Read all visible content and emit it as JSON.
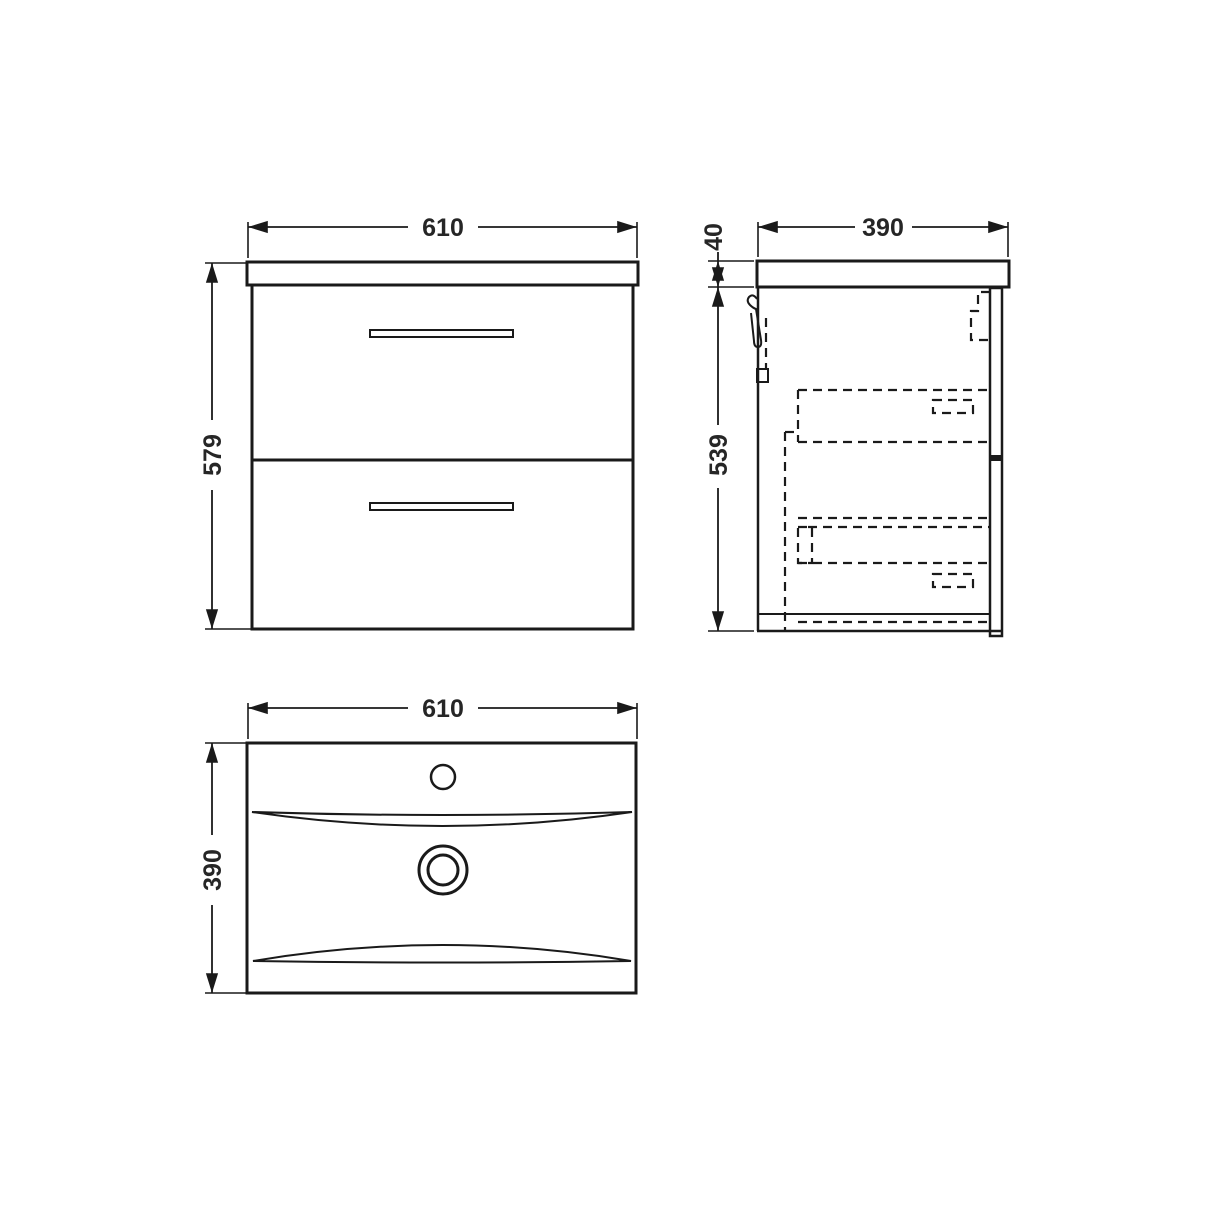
{
  "drawing": {
    "front_view": {
      "width": "610",
      "height": "579"
    },
    "side_view": {
      "depth": "390",
      "counter_thickness": "40",
      "cabinet_height": "539"
    },
    "plan_view": {
      "width": "610",
      "depth": "390"
    }
  },
  "colors": {
    "line": "#1a1a1a",
    "text": "#262626",
    "background": "#ffffff"
  }
}
